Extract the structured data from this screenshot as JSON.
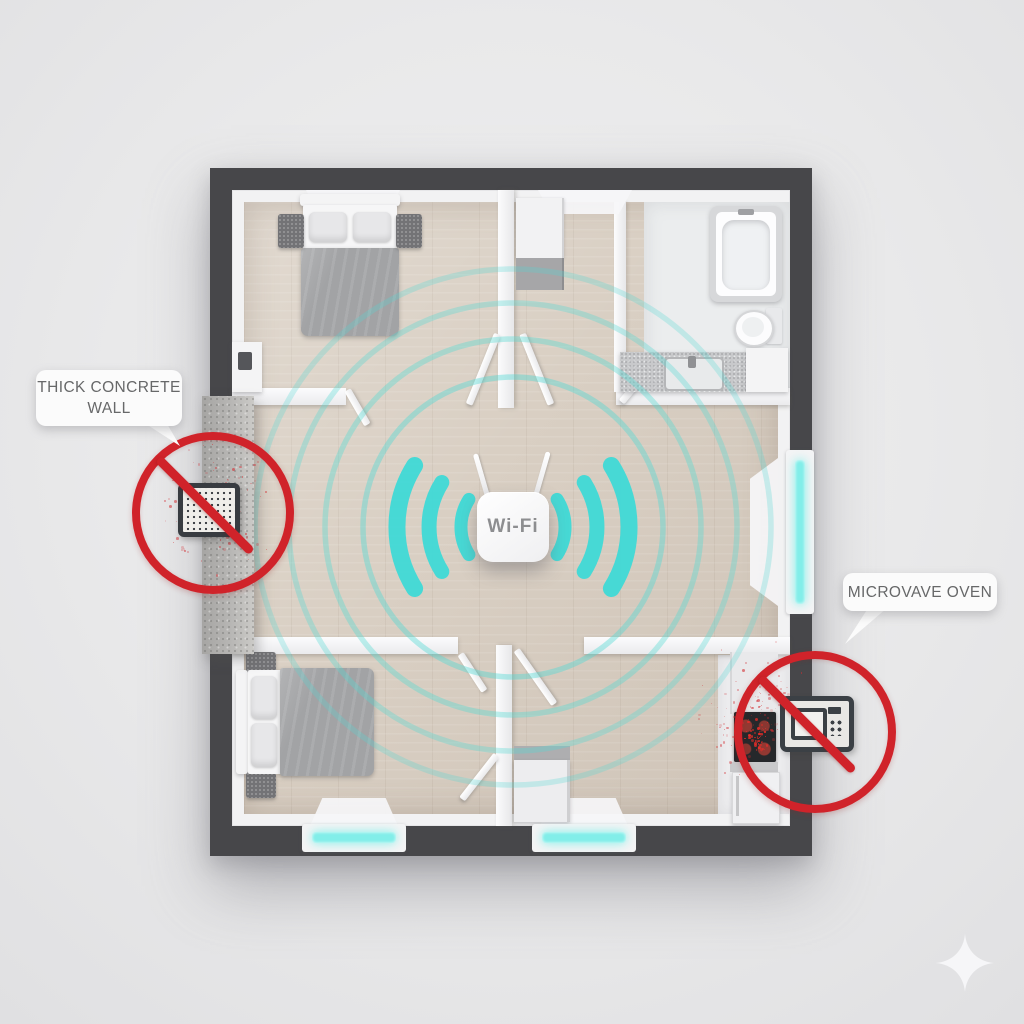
{
  "scene": {
    "description": "Top-down 3D floor plan illustration of Wi-Fi router placement: signal rings radiate from a central router; a thick concrete wall and a microwave oven are marked with red prohibition signs as signal blockers",
    "colors": {
      "background": "#e9e9ea",
      "outer_wall": "#47474a",
      "wood_floor": "#d9cfc3",
      "signal_cyan": "#3fd9d6",
      "ring_cyan": "#54d9d3",
      "alert_red": "#d0232a",
      "window_glow": "#82eee9",
      "label_text": "#676869",
      "label_background": "#fbfbfb"
    }
  },
  "router": {
    "label": "Wi-Fi"
  },
  "callouts": {
    "concrete_wall": {
      "line1": "THICK CONCRETE",
      "line2": "WALL"
    },
    "microwave_oven": {
      "text": "MICROVAVE OVEN"
    }
  },
  "icons": {
    "router": "wifi-router-icon",
    "blocked_device": "signal-device-grille-icon",
    "microwave": "microwave-oven-icon",
    "prohibition": "no-sign-icon",
    "sparkle": "four-point-star-icon"
  }
}
